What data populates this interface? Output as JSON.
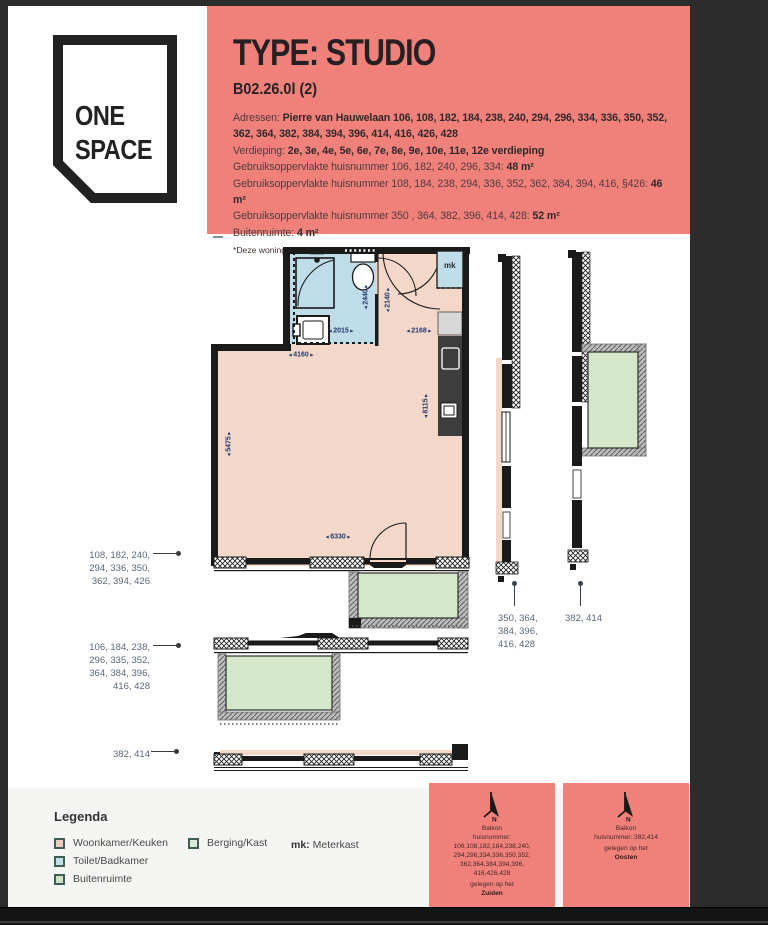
{
  "logo": {
    "line1": "ONE",
    "line2": "SPACE"
  },
  "header": {
    "title": "TYPE: STUDIO",
    "subtitle": "B02.26.0l (2)",
    "lines": [
      {
        "label": "Adressen: ",
        "value": "Pierre van Hauwelaan 106, 108, 182, 184, 238, 240, 294, 296, 334, 336, 350, 352, 362, 364, 382, 384, 394, 396, 414, 416, 426, 428"
      },
      {
        "label": "Verdieping: ",
        "value": "2e, 3e, 4e, 5e, 6e, 7e, 8e, 9e, 10e, 11e, 12e verdieping"
      },
      {
        "label": "Gebruiksoppervlakte huisnummer 106, 182, 240, 296, 334: ",
        "value": "48 m²"
      },
      {
        "label": "Gebruiksoppervlakte huisnummer 108, 184, 238, 294, 336, 352, 362, 384, 394, 416, §426: ",
        "value": "46 m²"
      },
      {
        "label": "Gebruiksoppervlakte huisnummer 350 , 364, 382, 396, 414, 428: ",
        "value": "52 m²"
      },
      {
        "label": "Buitenruimte: ",
        "value": "4 m²"
      }
    ],
    "footnote": "*Deze woning is gespiegeld."
  },
  "plan": {
    "mk_label": "mk",
    "dimensions": {
      "bath_depth": "2440",
      "hall_depth": "2140",
      "bath_width": "2015",
      "kitchen_width": "2168",
      "room_top_width": "4160",
      "kitchen_length": "8115",
      "room_depth": "5475",
      "room_bottom_width": "6330"
    },
    "left_labels": [
      {
        "text": "108, 182, 240,\n294, 336, 350,\n362, 394, 426"
      },
      {
        "text": "106, 184, 238,\n296, 335, 352,\n364, 384, 396,\n416, 428"
      },
      {
        "text": "382, 414"
      }
    ],
    "section_labels": [
      {
        "text": "350, 364,\n384, 396,\n416,  428"
      },
      {
        "text": "382, 414"
      }
    ]
  },
  "legend": {
    "title": "Legenda",
    "items": [
      {
        "label": "Woonkamer/Keuken",
        "color": "#eeccc0"
      },
      {
        "label": "Toilet/Badkamer",
        "color": "#c2dfe8"
      },
      {
        "label": "Buitenruimte",
        "color": "#cfe3c4"
      },
      {
        "label": "Berging/Kast",
        "color": "#dcead9"
      }
    ],
    "mk_abbr": "mk:",
    "mk_name": "Meterkast"
  },
  "balkon_notes": [
    {
      "compass_letter": "N",
      "title": "Balkon",
      "body": "huisnummer:\n106,108,182,184,238,240,\n294,296,334,336,350,352,\n362,364,384,394,396,\n416,426,428",
      "prefix": "gelegen op het",
      "direction": "Zuiden"
    },
    {
      "compass_letter": "N",
      "title": "Balkon",
      "body": "huisnummer: 382,414",
      "prefix": "gelegen op het",
      "direction": "Oosten"
    }
  ],
  "colors": {
    "accent_salmon": "#f0807a",
    "floor_pink": "#f3d8ca",
    "bathroom_blue": "#bedde9",
    "balcony_green": "#d4e7c8",
    "wall_black": "#1a1a1a",
    "kitchen_dark": "#3d3d3d"
  }
}
